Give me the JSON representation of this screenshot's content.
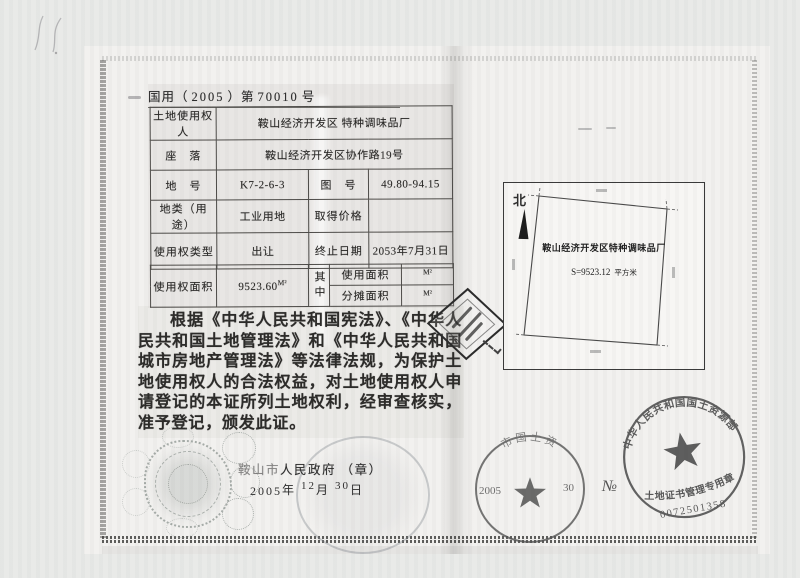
{
  "colors": {
    "ink": "#2e2e2e",
    "paper": "#f1f0ee",
    "stamp_gray": "#474747"
  },
  "header": {
    "doc_type": "国用（",
    "year": "2005",
    "mid": "）第",
    "serial": "70010",
    "suffix": "号"
  },
  "table": {
    "rows": [
      {
        "label": "土地使用权人",
        "value": "鞍山经济开发区 特种调味品厂"
      },
      {
        "label": "座　落",
        "value": "鞍山经济开发区协作路19号"
      },
      {
        "label": "地　号",
        "value": "K7-2-6-3",
        "label2": "图　号",
        "value2": "49.80-94.15"
      },
      {
        "label": "地类（用途）",
        "value": "工业用地",
        "label2": "取得价格",
        "value2": ""
      },
      {
        "label": "使用权类型",
        "value": "出让",
        "label2": "终止日期",
        "value2": "2053年7月31日"
      },
      {
        "label": "使用权面积",
        "value": "9523.60",
        "unit": "M²",
        "group_label": "其中",
        "sub_rows": [
          {
            "label": "使用面积",
            "unit": "M²"
          },
          {
            "label": "分摊面积",
            "unit": "M²"
          }
        ]
      }
    ]
  },
  "legal_text": "根据《中华人民共和国宪法》、《中华人民共和国土地管理法》和《中华人民共和国城市房地产管理法》等法律法规，为保护土地使用权人的合法权益，对土地使用权人申请登记的本证所列土地权利，经审查核实，准予登记，颁发此证。",
  "issuance": {
    "authority_city": "鞍山市",
    "authority_rest": "人民政府",
    "seal_note": "（章）",
    "year": "2005",
    "year_unit": "年",
    "month": "12",
    "month_unit": "月",
    "day": "30",
    "day_unit": "日"
  },
  "map": {
    "north_label": "北",
    "parcel_name": "鞍山经济开发区特种调味品厂",
    "area_value": "S=9523.12",
    "area_unit": "平方米"
  },
  "seals": {
    "local_seal": {
      "arc_text": "市国土资",
      "left_text": "2005",
      "right_text": "30"
    },
    "national_seal": {
      "arc_top": "中华人民共和国国土资源部",
      "banner": "土地证书管理专用章",
      "no_sign": "№",
      "number": "0072501358"
    }
  }
}
